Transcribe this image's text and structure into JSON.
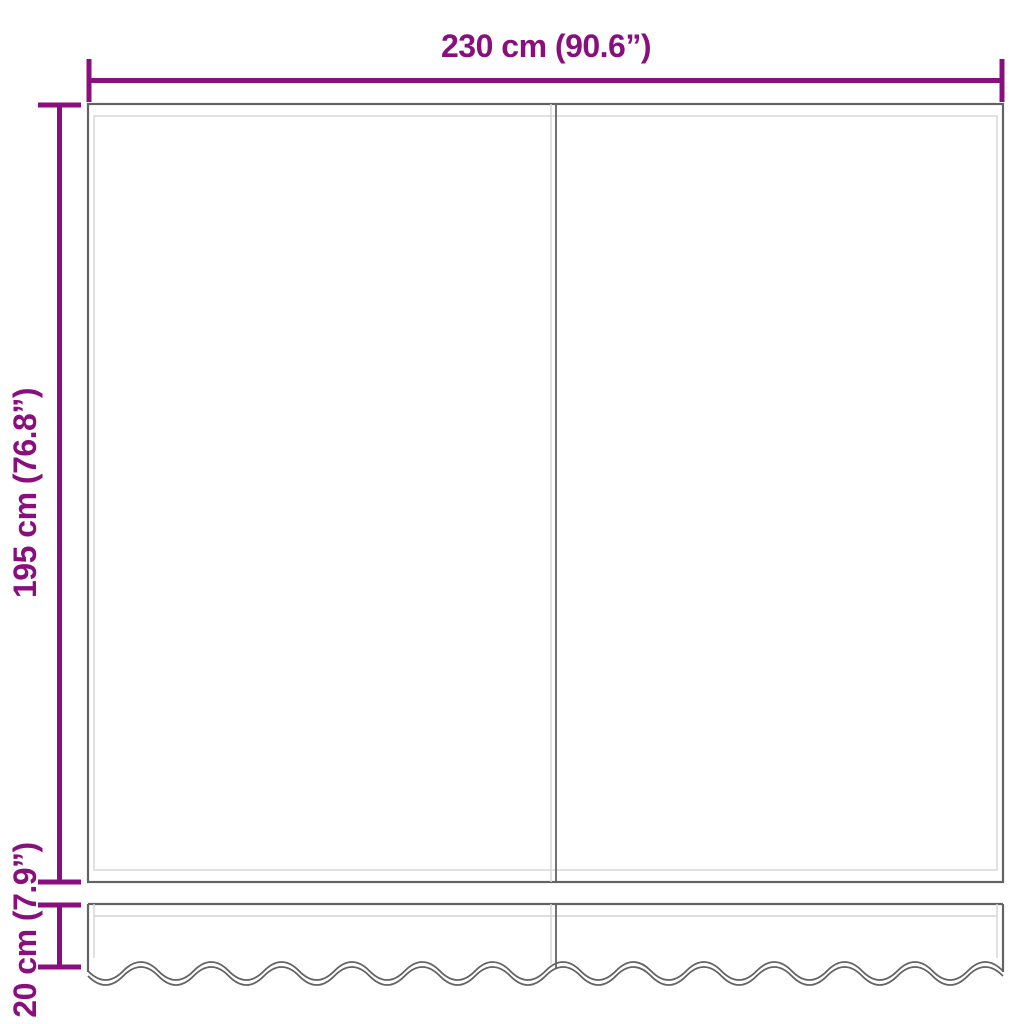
{
  "diagram": {
    "description": "Awning replacement fabric dimension diagram with main panel and scalloped valance",
    "dimensions": {
      "width": {
        "label": "230 cm (90.6”)",
        "value_cm": 230,
        "value_in": 90.6
      },
      "height": {
        "label": "195 cm (76.8”)",
        "value_cm": 195,
        "value_in": 76.8
      },
      "valance_height": {
        "label": "20 cm (7.9”)",
        "value_cm": 20,
        "value_in": 7.9
      }
    },
    "colors": {
      "dimension": "#8a0f7e",
      "outline_dark": "#636363",
      "outline_light": "#d4d4d4",
      "background": "#ffffff"
    }
  }
}
